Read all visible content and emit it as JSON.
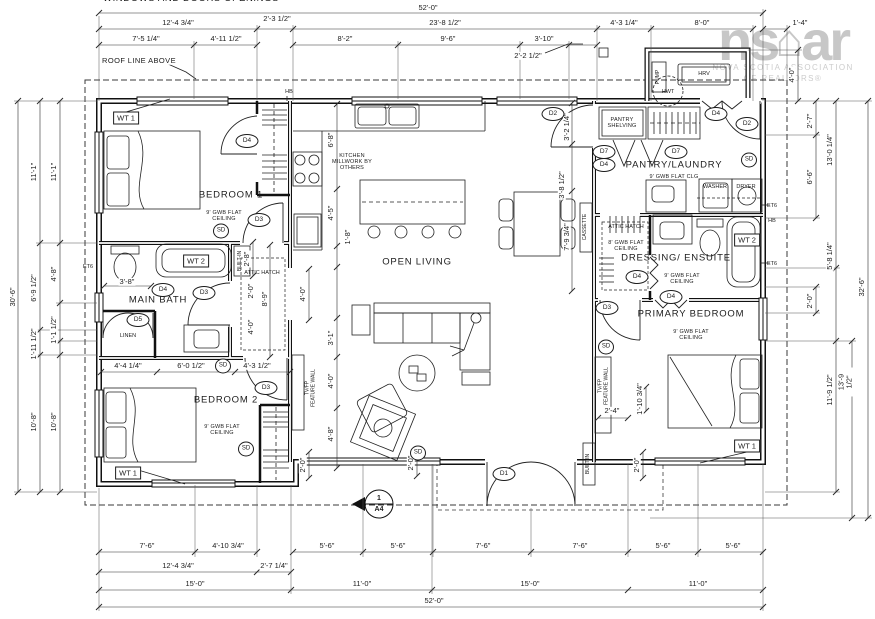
{
  "top_note": "WINDOWS AND DOORS OPENINGS",
  "watermark": {
    "logo_left": "ns",
    "house_glyph": "⌂",
    "logo_right": "ar",
    "line1": "NOVA SCOTIA ASSOCIATION",
    "line2": "OF REALTORS®"
  },
  "colors": {
    "ink": "#1c1c1c",
    "watermark_gray": "#c7c7c7"
  },
  "annotations": [
    {
      "t": "52'-0\"",
      "x": 428,
      "y": 8,
      "c": "dim"
    },
    {
      "t": "12'-4 3/4\"",
      "x": 178,
      "y": 23,
      "c": "dim"
    },
    {
      "t": "2'-3 1/2\"",
      "x": 277,
      "y": 19,
      "c": "dim"
    },
    {
      "t": "23'-8 1/2\"",
      "x": 445,
      "y": 23,
      "c": "dim"
    },
    {
      "t": "4'-3 1/4\"",
      "x": 624,
      "y": 23,
      "c": "dim"
    },
    {
      "t": "8'-0\"",
      "x": 702,
      "y": 23,
      "c": "dim"
    },
    {
      "t": "1'-4\"",
      "x": 800,
      "y": 23,
      "c": "dim"
    },
    {
      "t": "7'-5 1/4\"",
      "x": 146,
      "y": 39,
      "c": "dim"
    },
    {
      "t": "4'-11 1/2\"",
      "x": 226,
      "y": 39,
      "c": "dim"
    },
    {
      "t": "8'-2\"",
      "x": 345,
      "y": 39,
      "c": "dim"
    },
    {
      "t": "9'-6\"",
      "x": 448,
      "y": 39,
      "c": "dim"
    },
    {
      "t": "3'-10\"",
      "x": 544,
      "y": 39,
      "c": "dim"
    },
    {
      "t": "2'-2 1/2\"",
      "x": 528,
      "y": 56,
      "c": "dim"
    },
    {
      "t": "ROOF LINE ABOVE",
      "x": 139,
      "y": 61,
      "c": "note"
    },
    {
      "t": "30'-6\"",
      "x": 13,
      "y": 297,
      "c": "dimv"
    },
    {
      "t": "11'-1\"",
      "x": 34,
      "y": 172,
      "c": "dimv"
    },
    {
      "t": "11'-1\"",
      "x": 54,
      "y": 172,
      "c": "dimv"
    },
    {
      "t": "6'-9 1/2\"",
      "x": 34,
      "y": 288,
      "c": "dimv"
    },
    {
      "t": "4'-8\"",
      "x": 54,
      "y": 274,
      "c": "dimv"
    },
    {
      "t": "1'-11 1/2\"",
      "x": 34,
      "y": 344,
      "c": "dimv"
    },
    {
      "t": "1'-1 1/2\"",
      "x": 54,
      "y": 330,
      "c": "dimv"
    },
    {
      "t": "10'-8\"",
      "x": 34,
      "y": 422,
      "c": "dimv"
    },
    {
      "t": "10'-8\"",
      "x": 54,
      "y": 422,
      "c": "dimv"
    },
    {
      "t": "4'-0\"",
      "x": 792,
      "y": 75,
      "c": "dimv"
    },
    {
      "t": "2'-7\"",
      "x": 810,
      "y": 121,
      "c": "dimv"
    },
    {
      "t": "6'-6\"",
      "x": 810,
      "y": 177,
      "c": "dimv"
    },
    {
      "t": "2'-0\"",
      "x": 810,
      "y": 301,
      "c": "dimv"
    },
    {
      "t": "13'-0 1/4\"",
      "x": 830,
      "y": 150,
      "c": "dimv"
    },
    {
      "t": "5'-8 1/4\"",
      "x": 830,
      "y": 256,
      "c": "dimv"
    },
    {
      "t": "11'-9 1/2\"",
      "x": 830,
      "y": 390,
      "c": "dimv"
    },
    {
      "t": "13'-9 1/2\"",
      "x": 846,
      "y": 382,
      "c": "dimv"
    },
    {
      "t": "32'-6\"",
      "x": 862,
      "y": 287,
      "c": "dimv"
    },
    {
      "t": "7'-6\"",
      "x": 147,
      "y": 546,
      "c": "dim"
    },
    {
      "t": "4'-10 3/4\"",
      "x": 228,
      "y": 546,
      "c": "dim"
    },
    {
      "t": "5'-6\"",
      "x": 327,
      "y": 546,
      "c": "dim"
    },
    {
      "t": "5'-6\"",
      "x": 398,
      "y": 546,
      "c": "dim"
    },
    {
      "t": "7'-6\"",
      "x": 483,
      "y": 546,
      "c": "dim"
    },
    {
      "t": "7'-6\"",
      "x": 580,
      "y": 546,
      "c": "dim"
    },
    {
      "t": "5'-6\"",
      "x": 663,
      "y": 546,
      "c": "dim"
    },
    {
      "t": "5'-6\"",
      "x": 733,
      "y": 546,
      "c": "dim"
    },
    {
      "t": "12'-4 3/4\"",
      "x": 178,
      "y": 566,
      "c": "dim"
    },
    {
      "t": "2'-7 1/4\"",
      "x": 274,
      "y": 566,
      "c": "dim"
    },
    {
      "t": "15'-0\"",
      "x": 195,
      "y": 584,
      "c": "dim"
    },
    {
      "t": "11'-0\"",
      "x": 362,
      "y": 584,
      "c": "dim"
    },
    {
      "t": "15'-0\"",
      "x": 530,
      "y": 584,
      "c": "dim"
    },
    {
      "t": "11'-0\"",
      "x": 698,
      "y": 584,
      "c": "dim"
    },
    {
      "t": "52'-0\"",
      "x": 434,
      "y": 601,
      "c": "dim"
    },
    {
      "t": "4'-4 1/4\"",
      "x": 128,
      "y": 366,
      "c": "dim"
    },
    {
      "t": "6'-0 1/2\"",
      "x": 191,
      "y": 366,
      "c": "dim"
    },
    {
      "t": "4'-3 1/2\"",
      "x": 257,
      "y": 366,
      "c": "dim"
    },
    {
      "t": "6'-8\"",
      "x": 331,
      "y": 140,
      "c": "dimv"
    },
    {
      "t": "4'-5\"",
      "x": 331,
      "y": 213,
      "c": "dimv"
    },
    {
      "t": "1'-8\"",
      "x": 348,
      "y": 237,
      "c": "dimv"
    },
    {
      "t": "4'-0\"",
      "x": 303,
      "y": 294,
      "c": "dimv"
    },
    {
      "t": "3'-1\"",
      "x": 331,
      "y": 338,
      "c": "dimv"
    },
    {
      "t": "4'-0\"",
      "x": 331,
      "y": 381,
      "c": "dimv"
    },
    {
      "t": "4'-8\"",
      "x": 331,
      "y": 434,
      "c": "dimv"
    },
    {
      "t": "2'-0\"",
      "x": 303,
      "y": 465,
      "c": "dimv"
    },
    {
      "t": "2'-0\"",
      "x": 411,
      "y": 463,
      "c": "dimv"
    },
    {
      "t": "3'-2 1/4\"",
      "x": 567,
      "y": 127,
      "c": "dimv"
    },
    {
      "t": "3'-8 1/2\"",
      "x": 562,
      "y": 185,
      "c": "dimv"
    },
    {
      "t": "7'-9 3/4\"",
      "x": 567,
      "y": 237,
      "c": "dimv"
    },
    {
      "t": "2'-8\"",
      "x": 247,
      "y": 259,
      "c": "dimv"
    },
    {
      "t": "2'-0\"",
      "x": 251,
      "y": 291,
      "c": "dimv"
    },
    {
      "t": "8'-9\"",
      "x": 265,
      "y": 299,
      "c": "dimv"
    },
    {
      "t": "4'-0\"",
      "x": 251,
      "y": 327,
      "c": "dimv"
    },
    {
      "t": "1'-10 3/4\"",
      "x": 640,
      "y": 399,
      "c": "dimv"
    },
    {
      "t": "2'-0\"",
      "x": 637,
      "y": 465,
      "c": "dimv"
    },
    {
      "t": "3'-8\"",
      "x": 127,
      "y": 282,
      "c": "dim"
    },
    {
      "t": "2'-4\"",
      "x": 612,
      "y": 411,
      "c": "dim"
    },
    {
      "t": "BEDROOM 1",
      "x": 231,
      "y": 196,
      "c": "room"
    },
    {
      "t": "MAIN BATH",
      "x": 158,
      "y": 301,
      "c": "room"
    },
    {
      "t": "BEDROOM 2",
      "x": 226,
      "y": 401,
      "c": "room"
    },
    {
      "t": "OPEN LIVING",
      "x": 417,
      "y": 263,
      "c": "room"
    },
    {
      "t": "PANTRY/LAUNDRY",
      "x": 674,
      "y": 166,
      "c": "room"
    },
    {
      "t": "DRESSING/ ENSUITE",
      "x": 676,
      "y": 259,
      "c": "room"
    },
    {
      "t": "PRIMARY BEDROOM",
      "x": 691,
      "y": 315,
      "c": "room"
    },
    {
      "t": "9' GWB FLAT\nCEILING",
      "x": 224,
      "y": 216,
      "c": "sub"
    },
    {
      "t": "9' GWB FLAT\nCEILING",
      "x": 222,
      "y": 430,
      "c": "sub"
    },
    {
      "t": "9' GWB FLAT\nCEILING",
      "x": 682,
      "y": 279,
      "c": "sub"
    },
    {
      "t": "9' GWB FLAT\nCEILING",
      "x": 691,
      "y": 335,
      "c": "sub"
    },
    {
      "t": "9' GWB FLAT CLG",
      "x": 674,
      "y": 177,
      "c": "sub"
    },
    {
      "t": "8' GWB FLAT\nCEILING",
      "x": 626,
      "y": 246,
      "c": "sub"
    },
    {
      "t": "KITCHEN\nMILLWORK BY\nOTHERS",
      "x": 352,
      "y": 162,
      "c": "sub"
    },
    {
      "t": "PANTRY\nSHELVING",
      "x": 622,
      "y": 123,
      "c": "sub"
    },
    {
      "t": "ATTIC HATCH",
      "x": 626,
      "y": 227,
      "c": "tiny"
    },
    {
      "t": "ATTIC HATCH",
      "x": 262,
      "y": 273,
      "c": "tiny"
    },
    {
      "t": "WASHER",
      "x": 715,
      "y": 187,
      "c": "tiny"
    },
    {
      "t": "DRYER",
      "x": 746,
      "y": 187,
      "c": "tiny"
    },
    {
      "t": "LINEN",
      "x": 128,
      "y": 336,
      "c": "tiny"
    },
    {
      "t": "HRV",
      "x": 704,
      "y": 74,
      "c": "tiny"
    },
    {
      "t": "HWT",
      "x": 668,
      "y": 92,
      "c": "tiny"
    },
    {
      "t": "HB",
      "x": 289,
      "y": 92,
      "c": "tiny"
    },
    {
      "t": "ET6",
      "x": 88,
      "y": 267,
      "c": "tiny"
    },
    {
      "t": "ET6",
      "x": 772,
      "y": 206,
      "c": "tiny"
    },
    {
      "t": "HB",
      "x": 772,
      "y": 221,
      "c": "tiny"
    },
    {
      "t": "ET6",
      "x": 772,
      "y": 264,
      "c": "tiny"
    },
    {
      "t": "PUMP",
      "x": 659,
      "y": 77,
      "c": "tinyv"
    },
    {
      "t": "CASSETTE",
      "x": 586,
      "y": 227,
      "c": "tinyv"
    },
    {
      "t": "BUILT-IN",
      "x": 241,
      "y": 261,
      "c": "tinyv"
    },
    {
      "t": "BUILT-IN",
      "x": 589,
      "y": 464,
      "c": "tinyv"
    },
    {
      "t": "TV/FP\nFEATURE WALL",
      "x": 311,
      "y": 388,
      "c": "tinyv"
    },
    {
      "t": "TV/FP\nFEATURE WALL",
      "x": 604,
      "y": 386,
      "c": "tinyv"
    },
    {
      "t": "D1",
      "x": 504,
      "y": 474,
      "c": "tag"
    },
    {
      "t": "D2",
      "x": 553,
      "y": 114,
      "c": "tag"
    },
    {
      "t": "D2",
      "x": 747,
      "y": 124,
      "c": "tag"
    },
    {
      "t": "D3",
      "x": 259,
      "y": 220,
      "c": "tag"
    },
    {
      "t": "D4",
      "x": 163,
      "y": 290,
      "c": "tag"
    },
    {
      "t": "D3",
      "x": 204,
      "y": 293,
      "c": "tag"
    },
    {
      "t": "D3",
      "x": 266,
      "y": 388,
      "c": "tag"
    },
    {
      "t": "D3",
      "x": 607,
      "y": 308,
      "c": "tag"
    },
    {
      "t": "D4",
      "x": 247,
      "y": 141,
      "c": "tag"
    },
    {
      "t": "D7",
      "x": 604,
      "y": 152,
      "c": "tag"
    },
    {
      "t": "D4",
      "x": 604,
      "y": 165,
      "c": "tag"
    },
    {
      "t": "D7",
      "x": 676,
      "y": 152,
      "c": "tag"
    },
    {
      "t": "D4",
      "x": 716,
      "y": 114,
      "c": "tag"
    },
    {
      "t": "D4",
      "x": 637,
      "y": 277,
      "c": "tag"
    },
    {
      "t": "D4",
      "x": 671,
      "y": 297,
      "c": "tag"
    },
    {
      "t": "D5",
      "x": 138,
      "y": 320,
      "c": "tag"
    },
    {
      "t": "SD",
      "x": 221,
      "y": 231,
      "c": "sd"
    },
    {
      "t": "SD",
      "x": 246,
      "y": 449,
      "c": "sd"
    },
    {
      "t": "SD",
      "x": 418,
      "y": 453,
      "c": "sd"
    },
    {
      "t": "SD",
      "x": 749,
      "y": 160,
      "c": "sd"
    },
    {
      "t": "SD",
      "x": 606,
      "y": 347,
      "c": "sd"
    },
    {
      "t": "SD",
      "x": 223,
      "y": 366,
      "c": "sd"
    },
    {
      "t": "WT 1",
      "x": 126,
      "y": 118,
      "c": "wt"
    },
    {
      "t": "WT 2",
      "x": 196,
      "y": 261,
      "c": "wt"
    },
    {
      "t": "WT 1",
      "x": 128,
      "y": 473,
      "c": "wt"
    },
    {
      "t": "WT 2",
      "x": 747,
      "y": 240,
      "c": "wt"
    },
    {
      "t": "WT 1",
      "x": 747,
      "y": 446,
      "c": "wt"
    },
    {
      "t": "1",
      "x": 379,
      "y": 499,
      "c": "mark"
    },
    {
      "t": "A4",
      "x": 379,
      "y": 510,
      "c": "mark"
    }
  ]
}
